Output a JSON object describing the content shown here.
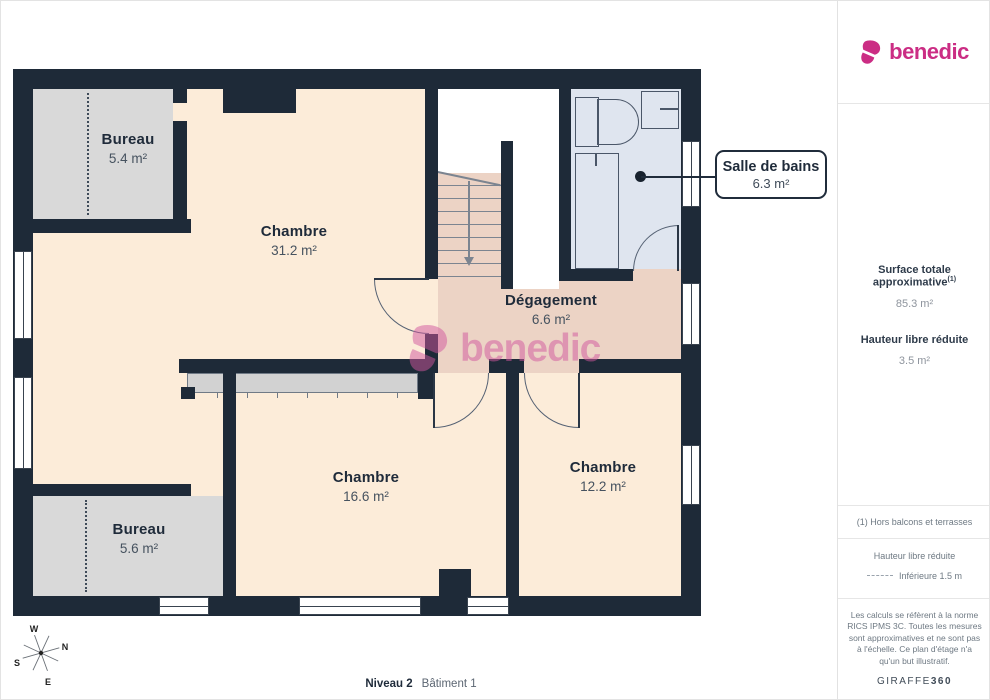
{
  "brand": {
    "name": "benedic"
  },
  "colors": {
    "brand": "#cb2d84",
    "wall": "#1e2a38",
    "floor": "#fcecd9",
    "room_gray": "#d9d9d9",
    "bath": "#dfe5ef",
    "hall": "#ecd3c5",
    "watermark": "#d2579f"
  },
  "plan": {
    "rooms": [
      {
        "name": "Bureau",
        "area": "5.4 m²"
      },
      {
        "name": "Chambre",
        "area": "31.2 m²"
      },
      {
        "name": "Dégagement",
        "area": "6.6 m²"
      },
      {
        "name": "Chambre",
        "area": "16.6 m²"
      },
      {
        "name": "Chambre",
        "area": "12.2 m²"
      },
      {
        "name": "Bureau",
        "area": "5.6 m²"
      }
    ],
    "callout": {
      "name": "Salle de bains",
      "area": "6.3 m²"
    },
    "compass": {
      "n": "N",
      "s": "S",
      "e": "E",
      "w": "W"
    },
    "footer": {
      "level": "Niveau 2",
      "building": "Bâtiment 1"
    }
  },
  "watermark": {
    "text": "benedic"
  },
  "sidebar": {
    "surface_title": "Surface totale approximative",
    "surface_sup": "(1)",
    "surface_value": "85.3 m²",
    "height_title": "Hauteur libre réduite",
    "height_value": "3.5 m²",
    "note": "(1) Hors balcons et terrasses",
    "legend_title": "Hauteur libre réduite",
    "legend_value": "Inférieure 1.5 m",
    "disclaimer": "Les calculs se réfèrent à la norme RICS IPMS 3C. Toutes les mesures sont approximatives et ne sont pas à l'échelle. Ce plan d'étage n'a qu'un but illustratif.",
    "credit_name": "GIRAFFE",
    "credit_suffix": "360"
  }
}
